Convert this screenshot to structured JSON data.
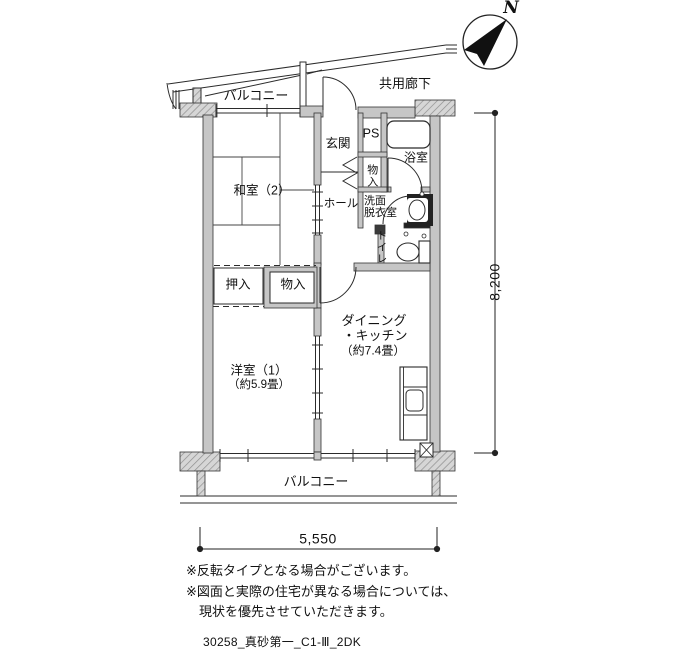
{
  "compass": {
    "north": "N"
  },
  "corridor": {
    "label": "共用廊下"
  },
  "balcony": {
    "top": "バルコニー",
    "bottom": "バルコニー"
  },
  "rooms": {
    "washitsu": "和室（2）",
    "genkan": "玄関",
    "ps": "PS",
    "bath": "浴室",
    "storage_upper": "物入",
    "hall": "ホール",
    "washroom_line1": "洗面",
    "washroom_line2": "脱衣室",
    "toilet": "トイレ",
    "oshiire": "押入",
    "storage_lower": "物入",
    "dk_line1": "ダイニング",
    "dk_line2": "・キッチン",
    "dk_line3": "（約7.4畳）",
    "yoshitsu_line1": "洋室（1）",
    "yoshitsu_line2": "（約5.9畳）"
  },
  "dimensions": {
    "width_mm": "5,550",
    "height_mm": "8,200"
  },
  "notes": {
    "line1": "※反転タイプとなる場合がございます。",
    "line2": "※図面と実際の住宅が異なる場合については、",
    "line3": "現状を優先させていただきます。"
  },
  "footer": "30258_真砂第一_C1-Ⅲ_2DK",
  "colors": {
    "wall_fill": "#c6c6c6",
    "block_fill": "#d6d6d6",
    "hatch": "#8f8f8f",
    "line": "#2b2b2b"
  }
}
